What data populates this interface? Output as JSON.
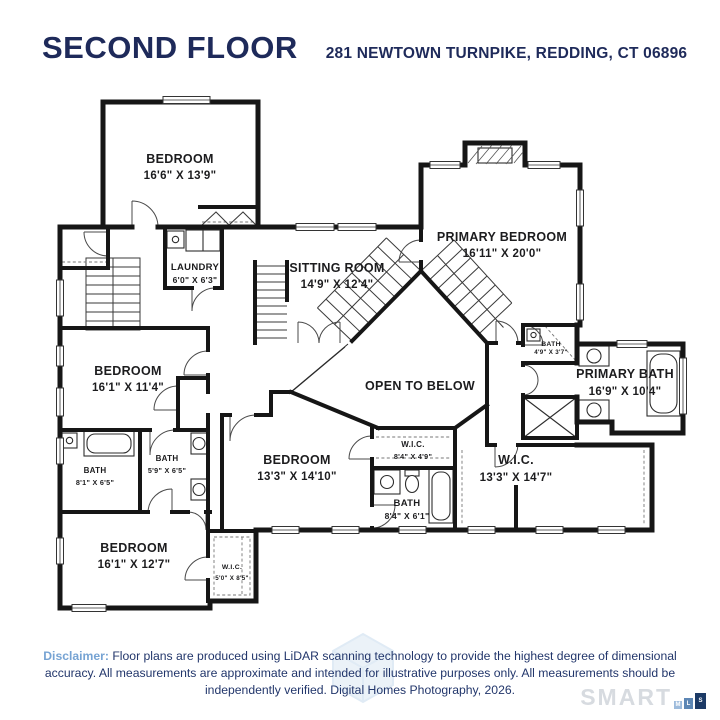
{
  "header": {
    "title": "SECOND FLOOR",
    "address": "281 NEWTOWN TURNPIKE, REDDING, CT 06896"
  },
  "rooms": {
    "bedroom_tl": {
      "name": "BEDROOM",
      "dims": "16'6\" X 13'9\""
    },
    "laundry": {
      "name": "LAUNDRY",
      "dims": "6'0\" X 6'3\""
    },
    "sitting": {
      "name": "SITTING ROOM",
      "dims": "14'9\" X 12'4\""
    },
    "primary_bedroom": {
      "name": "PRIMARY BEDROOM",
      "dims": "16'11\" X 20'0\""
    },
    "bedroom_left": {
      "name": "BEDROOM",
      "dims": "16'1\" X 11'4\""
    },
    "open_below": {
      "name": "OPEN TO BELOW"
    },
    "bath_small": {
      "name": "BATH",
      "dims": "4'9\" X 3'7\""
    },
    "primary_bath": {
      "name": "PRIMARY BATH",
      "dims": "16'9\" X 10'4\""
    },
    "bath_left": {
      "name": "BATH",
      "dims": "8'1\" X 6'5\""
    },
    "bath_mid": {
      "name": "BATH",
      "dims": "5'9\" X 6'5\""
    },
    "bedroom_mid": {
      "name": "BEDROOM",
      "dims": "13'3\" X 14'10\""
    },
    "wic_small": {
      "name": "W.I.C.",
      "dims": "8'4\" X 4'9\""
    },
    "wic_large": {
      "name": "W.I.C.",
      "dims": "13'3\" X 14'7\""
    },
    "bath_mid_bottom": {
      "name": "BATH",
      "dims": "8'4\" X 6'1\""
    },
    "bedroom_bl": {
      "name": "BEDROOM",
      "dims": "16'1\" X 12'7\""
    },
    "wic_bottom": {
      "name": "W.I.C.",
      "dims": "5'0\" X 8'5\""
    }
  },
  "footer": {
    "disclaimer_label": "Disclaimer:",
    "line1": "Floor plans are produced using LiDAR scanning technology to provide the highest degree of dimensional",
    "line2": "accuracy. All measurements are approximate and intended for illustrative purposes only. All measurements should be",
    "line3": "independently verified. Digital Homes Photography, 2026."
  },
  "watermark": {
    "brand": "SMART",
    "blocks": [
      "M",
      "L",
      "S"
    ]
  },
  "colors": {
    "navy": "#1e2a5a",
    "disclaimer_blue": "#76a3d3",
    "wall": "#161616",
    "watermark_gray": "#d7dbe0"
  }
}
